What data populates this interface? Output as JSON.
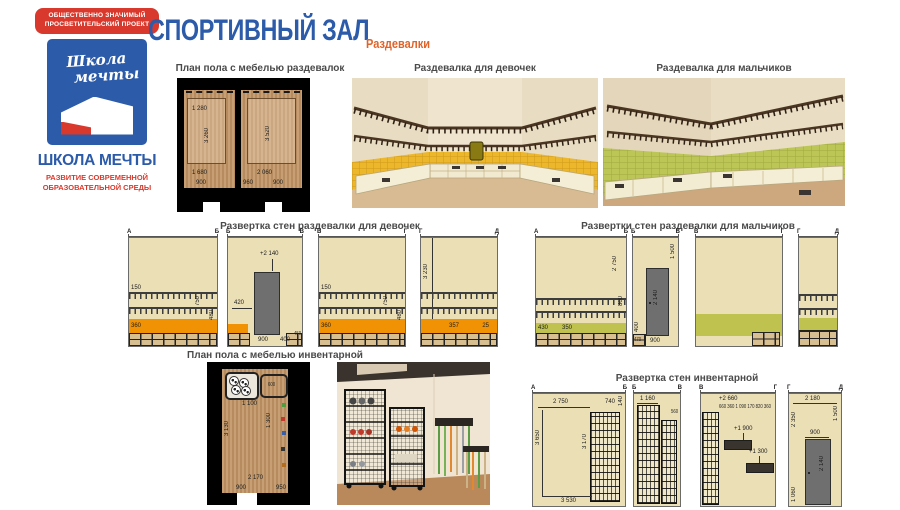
{
  "colors": {
    "brand_blue": "#2c5ba9",
    "brand_red": "#d9392c",
    "accent_orange": "#e0632a",
    "wall_beige": "#ebdfb6",
    "tile_yellow": "#edb72c",
    "tile_green": "#bcc657",
    "band_orange": "#f19204",
    "band_green": "#bfc24f",
    "door_gray": "#6f6f6f"
  },
  "brand": {
    "badge": [
      "ОБЩЕСТВЕННО ЗНАЧИМЫЙ",
      "ПРОСВЕТИТЕЛЬСКИЙ ПРОЕКТ"
    ],
    "logo_script": [
      "Школа",
      "мечты"
    ],
    "name": "ШКОЛА МЕЧТЫ",
    "tagline": [
      "РАЗВИТИЕ СОВРЕМЕННОЙ",
      "ОБРАЗОВАТЕЛЬНОЙ СРЕДЫ"
    ]
  },
  "header": {
    "title": "СПОРТИВНЫЙ ЗАЛ",
    "subtitle": "Раздевалки"
  },
  "plan_changing": {
    "title": "План пола с мебелью раздевалок",
    "room1": {
      "top": "1 280",
      "h": "3 260",
      "w": "1 680",
      "door": "900"
    },
    "room2": {
      "h": "3 520",
      "w": "2 060",
      "d1": "960",
      "d2": "900"
    }
  },
  "renders": {
    "girls_title": "Раздевалка для девочек",
    "boys_title": "Раздевалка для мальчиков"
  },
  "elev_girls": {
    "title": "Развертка стен раздевалки для девочек",
    "p1": {
      "l": "А",
      "r": "Б",
      "hook_h": "150",
      "band_l": "360",
      "wall_h": "750",
      "right_h": "480"
    },
    "p2": {
      "l": "Б",
      "r": "В",
      "door_top": "+2 140",
      "door_in": "420",
      "door_w": "900",
      "right_w": "400",
      "right_w2": "450"
    },
    "p3": {
      "l": "В",
      "r": "Г",
      "hook_h": "150",
      "band_l": "360",
      "wall_h": "750",
      "right_h": "480"
    },
    "p4": {
      "l": "Г",
      "r": "Д",
      "wall_h": "3 230",
      "shelf_w": "357",
      "gap": "25"
    }
  },
  "elev_boys": {
    "title": "Развертки стен раздевалки для мальчиков",
    "p1": {
      "l": "А",
      "r": "Б",
      "wall_h": "2 750",
      "hook_h": "800",
      "d1": "430",
      "d2": "350"
    },
    "p2": {
      "l": "Б",
      "r": "В",
      "top_h": "1 500",
      "door_h": "2 140",
      "d1": "470",
      "d2": "900",
      "d3": "400"
    },
    "p3": {
      "l": "В",
      "r": "Г"
    },
    "p4": {
      "l": "Г",
      "r": "Д"
    }
  },
  "plan_inv": {
    "title": "План пола с мебелью инвентарной",
    "top": "1 100",
    "h": "3 130",
    "mid": "1 300",
    "bin": "600",
    "b1": "2 170",
    "b2": "900",
    "b3": "950"
  },
  "elev_inv": {
    "title": "Развертка стен инвентарной",
    "p1": {
      "l": "А",
      "r": "Б",
      "top_w": "2 750",
      "rack_w": "740",
      "left_h": "3 650",
      "rack_h": "3 170",
      "bottom_w": "3 530",
      "s": "140"
    },
    "p2": {
      "l": "Б",
      "r": "В",
      "rack1_w": "1 160",
      "rack2_w": "560"
    },
    "p3": {
      "l": "В",
      "r": "Г",
      "top": "+2 660",
      "row": "660 360 1 090 170 820 360",
      "a1": "+1 900",
      "a2": "+1 300"
    },
    "p4": {
      "l": "Г",
      "r": "Д",
      "top_w": "2 180",
      "right_h": "1 500",
      "left_h": "2 350",
      "left_lo": "1 060",
      "door_w": "900",
      "door_h": "2 140"
    }
  }
}
